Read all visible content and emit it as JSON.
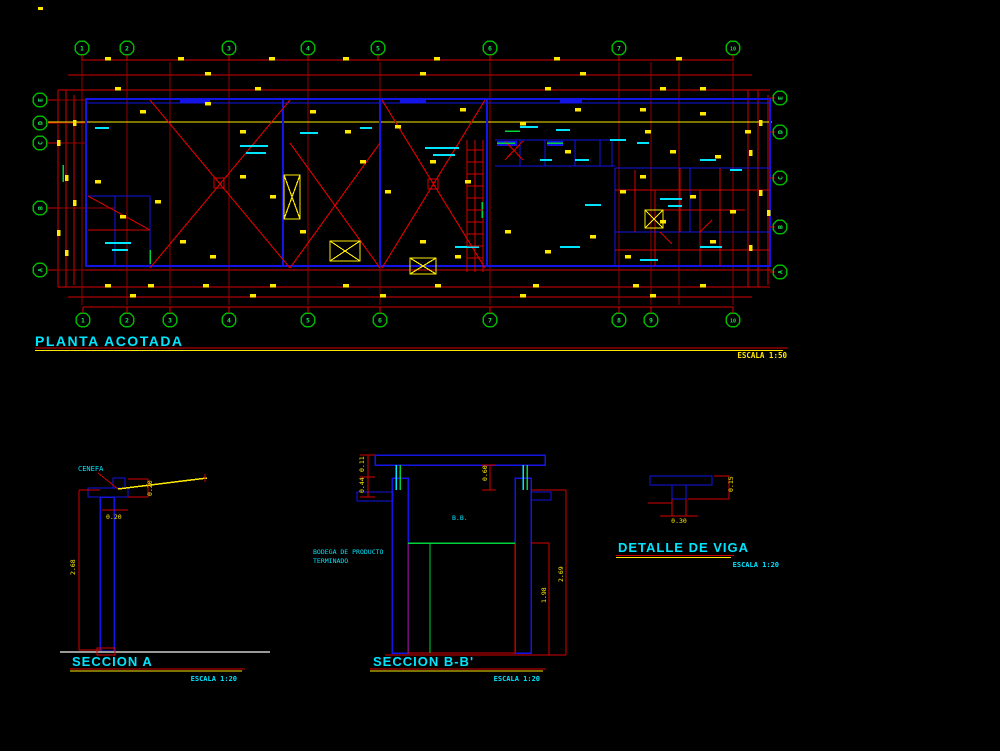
{
  "colors": {
    "background": "#000000",
    "line_red": "#d40000",
    "wall_blue": "#1414e6",
    "text_cyan": "#00e5ff",
    "dim_yellow": "#ffe900",
    "axis_green": "#00c832",
    "ground_gray": "#999999"
  },
  "plan": {
    "title": "PLANTA ACOTADA",
    "scale": "ESCALA 1:50",
    "axis_bubbles_top": [
      {
        "x": 82,
        "label": "1"
      },
      {
        "x": 127,
        "label": "2"
      },
      {
        "x": 229,
        "label": "3"
      },
      {
        "x": 308,
        "label": "4"
      },
      {
        "x": 378,
        "label": "5"
      },
      {
        "x": 490,
        "label": "6"
      },
      {
        "x": 619,
        "label": "7"
      },
      {
        "x": 733,
        "label": "10"
      }
    ],
    "axis_bubbles_bottom": [
      {
        "x": 83,
        "label": "1"
      },
      {
        "x": 127,
        "label": "2"
      },
      {
        "x": 170,
        "label": "3"
      },
      {
        "x": 229,
        "label": "4"
      },
      {
        "x": 308,
        "label": "5"
      },
      {
        "x": 380,
        "label": "6"
      },
      {
        "x": 490,
        "label": "7"
      },
      {
        "x": 619,
        "label": "8"
      },
      {
        "x": 651,
        "label": "9"
      },
      {
        "x": 733,
        "label": "10"
      }
    ],
    "axis_bubbles_left": [
      {
        "y": 100,
        "label": "E"
      },
      {
        "y": 123,
        "label": "D"
      },
      {
        "y": 143,
        "label": "C"
      },
      {
        "y": 208,
        "label": "B"
      },
      {
        "y": 270,
        "label": "A"
      }
    ],
    "axis_bubbles_right": [
      {
        "y": 98,
        "label": "E"
      },
      {
        "y": 132,
        "label": "D"
      },
      {
        "y": 178,
        "label": "C"
      },
      {
        "y": 227,
        "label": "B"
      },
      {
        "y": 272,
        "label": "A"
      }
    ]
  },
  "seccion_a": {
    "title": "SECCION A",
    "scale": "ESCALA 1:20",
    "cenefa_label": "CENEFA",
    "dim_height": "2.68",
    "dim_cap": "0.20",
    "dim_ledge": "0.20"
  },
  "seccion_bb": {
    "title": "SECCION B-B'",
    "scale": "ESCALA 1:20",
    "room_label_line1": "BODEGA DE PRODUCTO",
    "room_label_line2": "TERMINADO",
    "level_label": "B.B.",
    "dim_top_a": "0.11",
    "dim_top_b": "0.44",
    "dim_clerestory": "0.60",
    "dim_mesh": "1.98",
    "dim_total": "2.69"
  },
  "detalle_viga": {
    "title": "DETALLE DE VIGA",
    "scale": "ESCALA 1:20",
    "dim_right": "0.15",
    "dim_bottom": "0.30"
  }
}
